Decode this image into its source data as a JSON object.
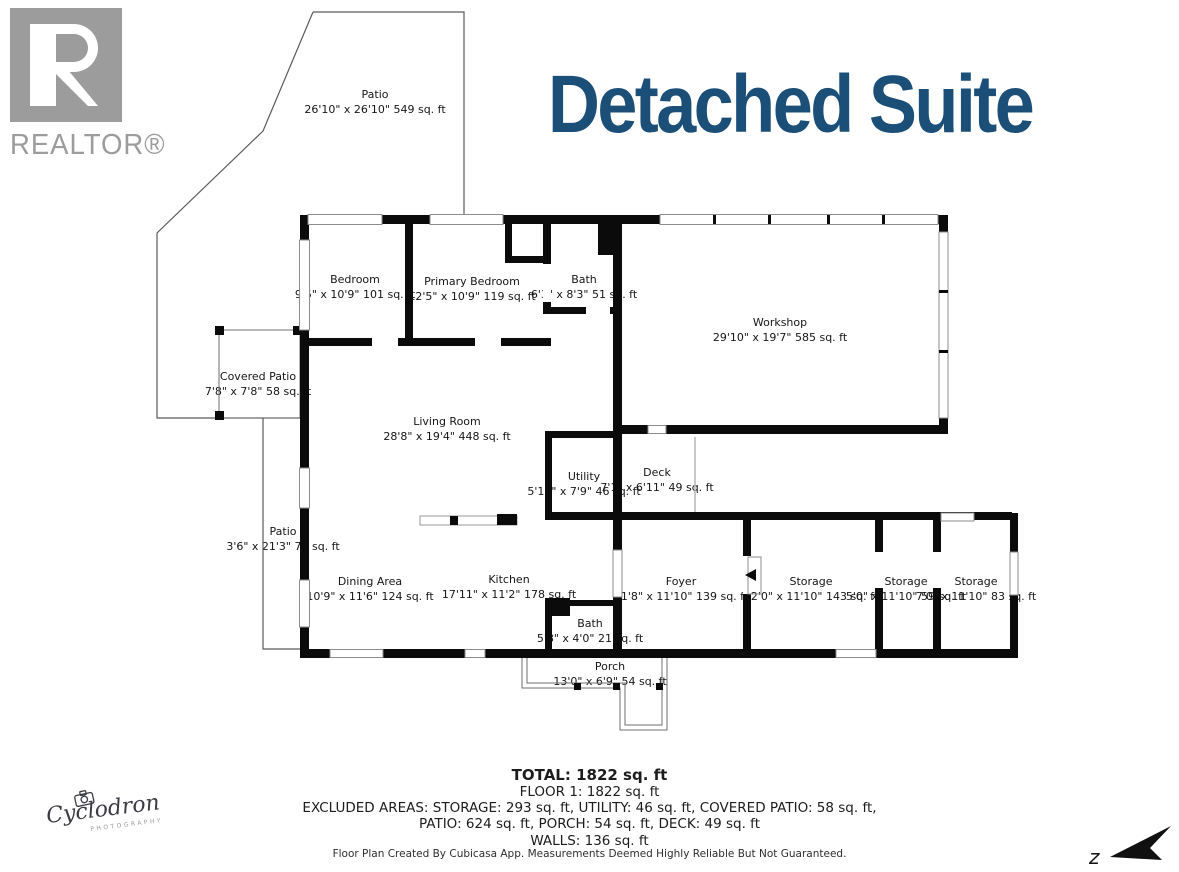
{
  "title": "Detached Suite",
  "branding": {
    "realtor_text": "REALTOR®",
    "photographer_name": "Cyclodron",
    "photographer_subtitle": "PHOTOGRAPHY"
  },
  "compass": {
    "label": "z"
  },
  "rooms": [
    {
      "name": "Patio",
      "dims": "26'10\" x 26'10\" 549 sq. ft"
    },
    {
      "name": "Bedroom",
      "dims": "9'5\" x 10'9\" 101 sq. ft"
    },
    {
      "name": "Primary Bedroom",
      "dims": "12'5\" x 10'9\" 119 sq. ft"
    },
    {
      "name": "Bath",
      "dims": "6'3\" x 8'3\" 51 sq. ft"
    },
    {
      "name": "Workshop",
      "dims": "29'10\" x 19'7\" 585 sq. ft"
    },
    {
      "name": "Covered Patio",
      "dims": "7'8\" x 7'8\" 58 sq. ft"
    },
    {
      "name": "Living Room",
      "dims": "28'8\" x 19'4\" 448 sq. ft"
    },
    {
      "name": "Utility",
      "dims": "5'10\" x 7'9\" 46 sq. ft"
    },
    {
      "name": "Deck",
      "dims": "7'1\" x 6'11\" 49 sq. ft"
    },
    {
      "name": "Patio",
      "dims": "3'6\" x 21'3\" 75 sq. ft"
    },
    {
      "name": "Dining Area",
      "dims": "10'9\" x 11'6\" 124 sq. ft"
    },
    {
      "name": "Kitchen",
      "dims": "17'11\" x 11'2\" 178 sq. ft"
    },
    {
      "name": "Foyer",
      "dims": "11'8\" x 11'10\" 139 sq. ft"
    },
    {
      "name": "Storage",
      "dims": "12'0\" x 11'10\" 143 sq. ft"
    },
    {
      "name": "Storage",
      "dims": "5'0\" x 11'10\" 59 sq. ft"
    },
    {
      "name": "Storage",
      "dims": "7'0\" x 11'10\" 83 sq. ft"
    },
    {
      "name": "Bath",
      "dims": "5'8\" x 4'0\" 21 sq. ft"
    },
    {
      "name": "Porch",
      "dims": "13'0\" x 6'9\" 54 sq. ft"
    }
  ],
  "summary": {
    "total": "TOTAL: 1822 sq. ft",
    "floor": "FLOOR 1: 1822 sq. ft",
    "excluded_line1": "EXCLUDED AREAS: STORAGE: 293 sq. ft, UTILITY: 46 sq. ft, COVERED PATIO: 58 sq. ft,",
    "excluded_line2": "PATIO: 624 sq. ft, PORCH: 54 sq. ft, DECK: 49 sq. ft",
    "walls": "WALLS: 136 sq. ft",
    "disclaimer": "Floor Plan Created By Cubicasa App. Measurements Deemed Highly Reliable But Not Guaranteed."
  }
}
